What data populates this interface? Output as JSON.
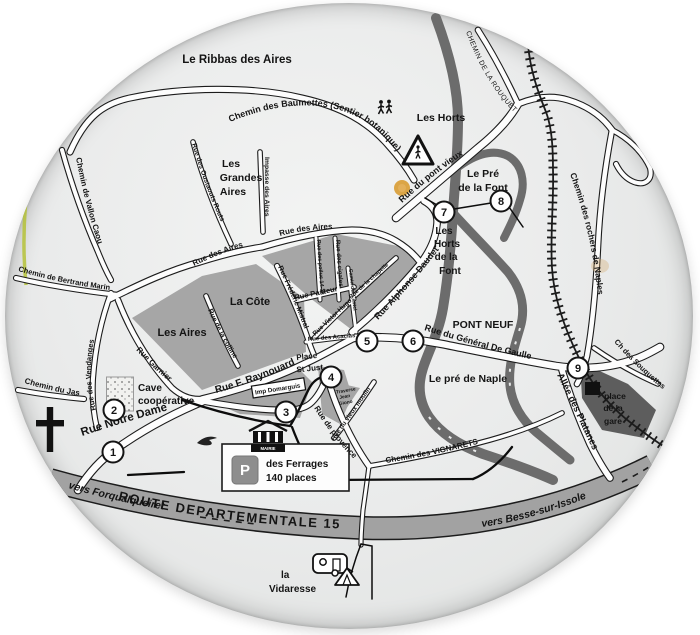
{
  "map": {
    "plate_color": "#e9eaea",
    "road_fill": "#fdfdfd",
    "road_casing": "#1c1c1c",
    "district_color": "#a6a6a6",
    "river_color": "#6c6c6c",
    "d15_band_color": "#a2a2a2",
    "station_area_color": "#5d5d5d",
    "text_color": "#141414",
    "accent_yellow": "#d89c33",
    "rim_green": "#b5c238"
  },
  "path_labels": [
    {
      "name": "label-chemin-des-baumettes",
      "text": "Chemin des Baumettes  (Sentier botanique)",
      "path": "M 230,122 C 295,95 350,102 382,135 C 396,149 406,163 414,180",
      "size": 9,
      "bold": true
    },
    {
      "name": "label-chemin-de-la-rouquette",
      "text": "CHEMIN DE LA ROUQUETTE",
      "path": "M 466,32 C 477,62 493,92 516,114",
      "size": 7,
      "bold": false,
      "spacing": 0.4
    },
    {
      "name": "label-rue-du-pont-vieux",
      "text": "Rue du pont vieux",
      "path": "M 402,203 C 426,181 450,162 478,146",
      "size": 9,
      "bold": true
    },
    {
      "name": "label-chemin-des-rochers-de-naples",
      "text": "Chemin des rochers de Naples",
      "path": "M 570,174 C 586,218 596,262 599,310",
      "size": 8.5,
      "bold": true
    },
    {
      "name": "label-ch-des-souquettes",
      "text": "Ch des Souquettes",
      "path": "M 614,342 C 630,360 646,376 664,390",
      "size": 7.5,
      "bold": true
    },
    {
      "name": "label-rue-du-general-de-gaulle",
      "text": "Rue du Général De Gaulle",
      "path": "M 424,330 C 462,342 500,353 540,361",
      "size": 9,
      "bold": true
    },
    {
      "name": "label-allee-des-platanes",
      "text": "Allée des Platanes",
      "path": "M 557,375 C 571,403 584,431 597,459",
      "size": 9.5,
      "bold": true
    },
    {
      "name": "label-rue-alphonse-daudet",
      "text": "Rue Alphonse Daudet",
      "path": "M 378,320 C 399,298 421,273 441,247",
      "size": 9,
      "bold": true
    },
    {
      "name": "label-chemin-des-vignarets",
      "text": "Chemin des VIGNARETS",
      "path": "M 386,463 C 423,457 457,450 492,440",
      "size": 8,
      "bold": true
    },
    {
      "name": "label-vers-forqualqueiret",
      "text": "vers Forqualqueiret",
      "path": "M 68,488 C 110,500 150,508 192,514",
      "size": 10.5,
      "bold": true,
      "italic": true
    },
    {
      "name": "label-route-departementale-15",
      "text": "ROUTE DEPARTEMENTALE 15",
      "path": "M 118,500 C 230,526 350,533 468,528",
      "size": 13,
      "bold": true,
      "spacing": 1.5
    },
    {
      "name": "label-vers-besse-sur-issole",
      "text": "vers Besse-sur-Issole",
      "path": "M 482,527 C 530,520 575,504 618,485",
      "size": 10.5,
      "bold": true,
      "italic": true
    },
    {
      "name": "label-rue-des-oustaouts-routs",
      "text": "Rue des Oustaouts Routs",
      "path": "M 192,144 C 202,178 215,212 232,244",
      "size": 6.8,
      "bold": true
    },
    {
      "name": "label-chemin-de-vallon-caou",
      "text": "Chemin de Vallon Caou",
      "path": "M 76,158 C 83,194 92,228 103,258",
      "size": 8,
      "bold": true
    },
    {
      "name": "label-chemin-de-bertrand-marin",
      "text": "Chemin de Bertrand Marin",
      "path": "M 18,271 C 52,281 84,287 118,291",
      "size": 7.5,
      "bold": true
    },
    {
      "name": "label-chemin-du-jas",
      "text": "Chemin du Jas",
      "path": "M 24,383 C 44,389 62,393 82,396",
      "size": 8,
      "bold": true
    },
    {
      "name": "label-rue-des-vendanges",
      "text": "Rue des Vendanges",
      "path": "M 96,410 C 90,386 89,362 95,336",
      "size": 7.5,
      "bold": true
    },
    {
      "name": "label-rue-garnier",
      "text": "Rue Garnier",
      "path": "M 136,350 C 150,365 164,378 180,390",
      "size": 8,
      "bold": true
    },
    {
      "name": "label-rue-notre-dame",
      "text": "Rue Notre Dame",
      "path": "M 82,436 C 118,424 152,414 188,405",
      "size": 11.5,
      "bold": true
    },
    {
      "name": "label-rue-f-raynouard",
      "text": "Rue F. Raynouard",
      "path": "M 216,393 C 246,385 274,374 302,361",
      "size": 10,
      "bold": true
    },
    {
      "name": "label-rue-des-aires-west",
      "text": "Rue des Aires",
      "path": "M 194,266 C 212,257 230,250 250,245",
      "size": 8,
      "bold": true
    },
    {
      "name": "label-rue-des-aires-north",
      "text": "Rue des Aires",
      "path": "M 280,236 C 298,231 316,229 336,229",
      "size": 8,
      "bold": true
    },
    {
      "name": "label-impasse-des-aires",
      "text": "Impasse des Aires",
      "path": "M 265,157 L 265,230",
      "size": 6.8,
      "bold": true
    },
    {
      "name": "label-rue-des-poilus",
      "text": "Rue des poilus 14-18",
      "path": "M 317,240 L 321,299",
      "size": 5.5,
      "bold": true
    },
    {
      "name": "label-rue-des-cigales",
      "text": "Rue des cigales",
      "path": "M 336,240 L 340,298",
      "size": 6.2,
      "bold": true
    },
    {
      "name": "label-rue-de-la-chapelle",
      "text": "Rue de la chapelle",
      "path": "M 351,299 L 398,257",
      "size": 5.8,
      "bold": true
    },
    {
      "name": "label-camin-dei-castel",
      "text": "Camin dei Castel",
      "path": "M 349,269 L 356,333",
      "size": 5.2,
      "bold": true
    },
    {
      "name": "label-rue-frederic-mistral",
      "text": "Rue Frédéric Mistral",
      "path": "M 278,267 C 290,292 300,316 309,341",
      "size": 7,
      "bold": true
    },
    {
      "name": "label-rue-pasteur",
      "text": "Rue Pasteur",
      "path": "M 295,300 L 352,288",
      "size": 7.5,
      "bold": true
    },
    {
      "name": "label-rue-victor-hugo",
      "text": "Rue Victor Hugo",
      "path": "M 315,336 L 352,301",
      "size": 6.5,
      "bold": true
    },
    {
      "name": "label-rue-des-acacias",
      "text": "Rue des Acacias",
      "path": "M 308,341 L 356,337",
      "size": 6,
      "bold": true
    },
    {
      "name": "label-rue-de-la-colline",
      "text": "Rue de la colline",
      "path": "M 208,310 C 217,330 226,347 237,363",
      "size": 7,
      "bold": true
    },
    {
      "name": "label-rue-de-provence",
      "text": "Rue de provence",
      "path": "M 314,408 C 326,427 339,444 354,459",
      "size": 8,
      "bold": true
    },
    {
      "name": "label-rue-du-vieux-moulin",
      "text": "Rue du vieux moulin",
      "path": "M 334,441 L 377,380",
      "size": 6.5,
      "bold": true
    }
  ],
  "point_labels": [
    {
      "name": "label-le-ribbas-des-aires",
      "text": "Le Ribbas des Aires",
      "x": 237,
      "y": 63,
      "size": 11.5
    },
    {
      "name": "label-les-horts",
      "text": "Les Horts",
      "x": 441,
      "y": 121,
      "size": 10.5
    },
    {
      "name": "label-le-pre-de-la-font-1",
      "text": "Le Pré",
      "x": 483,
      "y": 177,
      "size": 10.5
    },
    {
      "name": "label-le-pre-de-la-font-2",
      "text": "de la Font",
      "x": 483,
      "y": 191,
      "size": 10.5
    },
    {
      "name": "label-les-horts-de-la-font-1",
      "text": "Les",
      "x": 444,
      "y": 234,
      "size": 10
    },
    {
      "name": "label-les-horts-de-la-font-2",
      "text": "Horts",
      "x": 447,
      "y": 247,
      "size": 10
    },
    {
      "name": "label-les-horts-de-la-font-3",
      "text": "de la",
      "x": 446,
      "y": 260,
      "size": 10
    },
    {
      "name": "label-les-horts-de-la-font-4",
      "text": "Font",
      "x": 450,
      "y": 274,
      "size": 10
    },
    {
      "name": "label-pont-neuf",
      "text": "PONT NEUF",
      "x": 483,
      "y": 328,
      "size": 10.5
    },
    {
      "name": "label-le-pre-de-naple",
      "text": "Le pré de Naple",
      "x": 468,
      "y": 382,
      "size": 10.5
    },
    {
      "name": "label-place-de-la-gare-1",
      "text": "place",
      "x": 615,
      "y": 399,
      "size": 8.5
    },
    {
      "name": "label-place-de-la-gare-2",
      "text": "de la",
      "x": 613,
      "y": 411,
      "size": 8.5
    },
    {
      "name": "label-place-de-la-gare-3",
      "text": "gare",
      "x": 613,
      "y": 424,
      "size": 8.5
    },
    {
      "name": "label-les-grandes-aires-1",
      "text": "Les",
      "x": 231,
      "y": 167,
      "size": 10.5
    },
    {
      "name": "label-les-grandes-aires-2",
      "text": "Grandes",
      "x": 241,
      "y": 181,
      "size": 10.5
    },
    {
      "name": "label-les-grandes-aires-3",
      "text": "Aires",
      "x": 233,
      "y": 195,
      "size": 10.5
    },
    {
      "name": "label-la-cote",
      "text": "La Côte",
      "x": 250,
      "y": 305,
      "size": 11
    },
    {
      "name": "label-les-aires",
      "text": "Les Aires",
      "x": 182,
      "y": 336,
      "size": 11
    },
    {
      "name": "label-cave-cooperative-1",
      "text": "Cave",
      "x": 138,
      "y": 391,
      "size": 10,
      "anchor": "start"
    },
    {
      "name": "label-cave-cooperative-2",
      "text": "coopérative",
      "x": 138,
      "y": 404,
      "size": 10,
      "anchor": "start"
    },
    {
      "name": "label-parking-des-ferrages-1",
      "text": "des Ferrages",
      "x": 266,
      "y": 467,
      "size": 10,
      "anchor": "start"
    },
    {
      "name": "label-parking-des-ferrages-2",
      "text": "140 places",
      "x": 266,
      "y": 481,
      "size": 10,
      "anchor": "start"
    },
    {
      "name": "label-la-vidaresse-1",
      "text": "la",
      "x": 281,
      "y": 578,
      "size": 10,
      "anchor": "start"
    },
    {
      "name": "label-la-vidaresse-2",
      "text": "Vidaresse",
      "x": 269,
      "y": 592,
      "size": 10,
      "anchor": "start"
    },
    {
      "name": "label-place-st-just-1",
      "text": "Place",
      "x": 307,
      "y": 359,
      "size": 8,
      "rotate": -6
    },
    {
      "name": "label-place-st-just-2",
      "text": "St Just",
      "x": 310,
      "y": 371,
      "size": 8,
      "rotate": -6
    },
    {
      "name": "label-imp-domarguis",
      "text": "Imp Domarguis",
      "x": 278,
      "y": 391,
      "size": 6.3,
      "rotate": -9
    },
    {
      "name": "label-traverse-1",
      "text": "Traverse",
      "x": 346,
      "y": 392,
      "size": 4.8,
      "rotate": -10
    },
    {
      "name": "label-traverse-2",
      "text": "Jean",
      "x": 345,
      "y": 398,
      "size": 4.8,
      "rotate": -10
    },
    {
      "name": "label-traverse-3",
      "text": "Giono",
      "x": 346,
      "y": 404,
      "size": 4.8,
      "rotate": -10
    },
    {
      "name": "label-mairie",
      "text": "MAIRIE",
      "x": 268,
      "y": 450,
      "size": 4.3,
      "fill": "#ffffff"
    },
    {
      "name": "label-parking-p",
      "text": "P",
      "x": 245,
      "y": 475,
      "size": 15,
      "fill": "#ffffff"
    }
  ],
  "markers": [
    {
      "n": "1",
      "x": 113,
      "y": 452
    },
    {
      "n": "2",
      "x": 114,
      "y": 410
    },
    {
      "n": "3",
      "x": 286,
      "y": 412
    },
    {
      "n": "4",
      "x": 331,
      "y": 377
    },
    {
      "n": "5",
      "x": 367,
      "y": 341
    },
    {
      "n": "6",
      "x": 413,
      "y": 341
    },
    {
      "n": "7",
      "x": 444,
      "y": 212
    },
    {
      "n": "8",
      "x": 501,
      "y": 201
    },
    {
      "n": "9",
      "x": 578,
      "y": 368
    }
  ],
  "icons": [
    {
      "name": "hikers-icon",
      "x": 385,
      "y": 108
    },
    {
      "name": "crossing-warning-icon",
      "x": 418,
      "y": 151
    },
    {
      "name": "calvary-cross-icon",
      "x": 50,
      "y": 429
    },
    {
      "name": "postal-bird-icon",
      "x": 207,
      "y": 441
    },
    {
      "name": "town-hall-icon",
      "x": 268,
      "y": 436
    },
    {
      "name": "parking-sign-icon",
      "x": 245,
      "y": 470
    },
    {
      "name": "caravan-icon",
      "x": 330,
      "y": 564
    },
    {
      "name": "tent-icon",
      "x": 347,
      "y": 577
    },
    {
      "name": "cave-cooperative-icon",
      "x": 120,
      "y": 394
    },
    {
      "name": "station-building-icon",
      "x": 592,
      "y": 388
    },
    {
      "name": "yellow-marker-dot",
      "x": 402,
      "y": 188
    }
  ]
}
